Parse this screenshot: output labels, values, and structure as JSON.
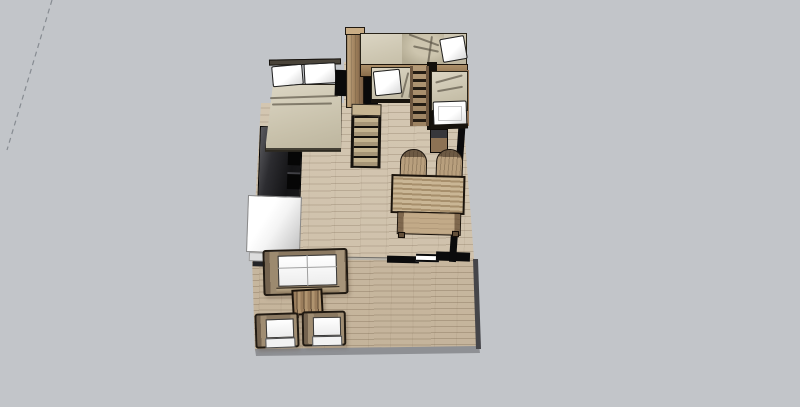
{
  "view": {
    "app_context": "3d-model-viewport",
    "scene_title": "Small apartment / tiny-house interior, 3D overhead view with terrace",
    "background_color": "#c2c5c9",
    "axis_guide": {
      "style": "dashed",
      "color": "#878c92"
    }
  },
  "palette": {
    "bg": "#c2c5c9",
    "outline": "#1d1711",
    "wall_black": "#0b0b0c",
    "wood_light": "#c0a886",
    "wood_mid": "#a1845f",
    "wood_dark": "#7c6347",
    "bedding_tan": "#d0c9b6",
    "bedding_shadow": "#b3ab93",
    "cushion_white": "#ffffff",
    "cushion_shade": "#e0e0e0",
    "counter_dark": "#1a1a1c",
    "counter_highlight": "#5b5b5f",
    "appliance_white": "#f4f4f4",
    "deck_rim": "#8e9094",
    "deck_edge_dark": "#454549",
    "axis_line": "#878c92"
  },
  "scene": {
    "objects": [
      {
        "id": "axis-guide",
        "label": "Dashed drawing-axis guide line"
      },
      {
        "id": "interior-floor",
        "label": "Interior wood plank floor"
      },
      {
        "id": "terrace-floor",
        "label": "Outdoor terrace wood deck"
      },
      {
        "id": "double-bed",
        "label": "Double bed with two white pillows"
      },
      {
        "id": "wardrobe",
        "label": "Tall wood wardrobe cabinet"
      },
      {
        "id": "staircase",
        "label": "Wood staircase to loft"
      },
      {
        "id": "loft-bed",
        "label": "Upper loft bunk bed with pillow"
      },
      {
        "id": "bunk-ladder",
        "label": "Bunk bed ladder"
      },
      {
        "id": "lower-bunk-bed",
        "label": "Lower bunk bed with white pillow"
      },
      {
        "id": "side-bunk-bed",
        "label": "Perpendicular bunk bed with white mattress"
      },
      {
        "id": "bedside-cabinet",
        "label": "Small cabinet at bed foot"
      },
      {
        "id": "kitchen-counter",
        "label": "Dark kitchen counter with open shelves"
      },
      {
        "id": "white-appliance",
        "label": "White appliance / counter block"
      },
      {
        "id": "dining-table",
        "label": "Slatted wood dining table"
      },
      {
        "id": "dining-chair-left",
        "label": "Dining chair"
      },
      {
        "id": "dining-chair-right",
        "label": "Dining chair"
      },
      {
        "id": "partition-wall",
        "label": "Black partition wall segments"
      },
      {
        "id": "window-opening",
        "label": "Door / window opening in wall"
      },
      {
        "id": "sofa",
        "label": "Wood-frame sofa with white cushions"
      },
      {
        "id": "coffee-table",
        "label": "Slatted coffee table"
      },
      {
        "id": "armchair-left",
        "label": "Armchair with white cushions"
      },
      {
        "id": "armchair-right",
        "label": "Armchair with white cushions"
      }
    ]
  }
}
